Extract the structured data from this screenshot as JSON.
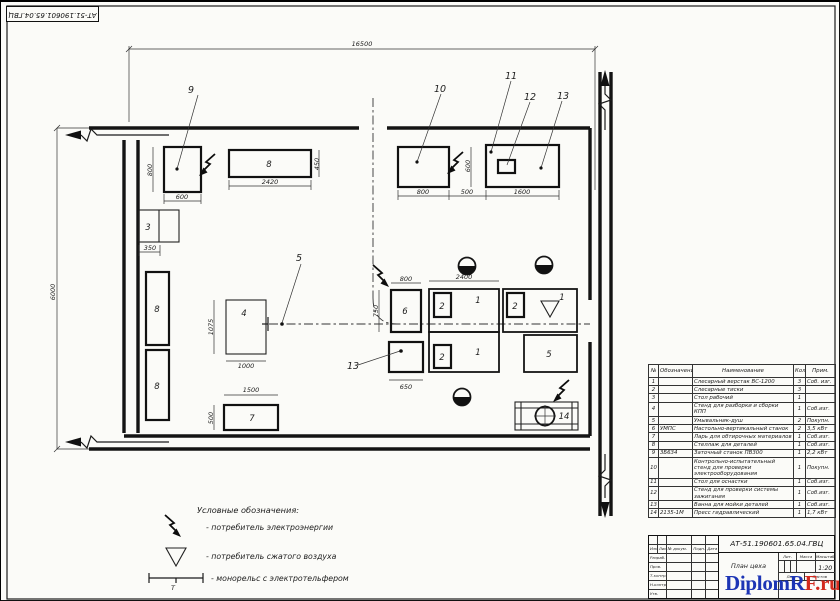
{
  "sheet": {
    "corner_designation": "АТ-51.190601.65.04.ГВЦ"
  },
  "plan": {
    "dims": {
      "overall_w": "16500",
      "overall_h": "6000",
      "i9_w": "600",
      "i9_h": "800",
      "b8_w": "2420",
      "b8_h": "450",
      "i3_w": "350",
      "i4_h": "1075",
      "i4_w": "1000",
      "i7_w": "1500",
      "i7_h": "500",
      "i6_w": "800",
      "i6_h": "750",
      "i13_w": "650",
      "wb_w": "2400",
      "i10_w": "800",
      "gap_w": "500",
      "i11_w": "1600",
      "i11_h": "600"
    },
    "labels": {
      "b8": "8",
      "r8a": "8",
      "r8b": "8",
      "i3": "3",
      "i4": "4",
      "i7": "7",
      "i6": "6",
      "wb1a": "1",
      "wb1b": "1",
      "wb1c": "1",
      "v2a": "2",
      "v2b": "2",
      "v2c": "2",
      "i5": "5",
      "i14": "14",
      "stop": "Т"
    },
    "callouts": {
      "c9": "9",
      "c10": "10",
      "c11": "11",
      "c12": "12",
      "c13": "13",
      "c5": "5",
      "c13b": "13"
    }
  },
  "legend": {
    "title": "Условные обозначения:",
    "electric": "- потребитель электроэнергии",
    "air": "- потребитель сжатого воздуха",
    "monorail": "- монорельс с электротельфером",
    "monorail_t": "Т"
  },
  "equipment_table": {
    "headers": [
      "№",
      "Обозначение",
      "Наименование",
      "Кол",
      "Прим."
    ],
    "rows": [
      {
        "n": "1",
        "code": "",
        "name": "Слесарный верстак ВС-1200",
        "qty": "3",
        "note": "Соб. изг."
      },
      {
        "n": "2",
        "code": "",
        "name": "Слесарные тиски",
        "qty": "3",
        "note": ""
      },
      {
        "n": "3",
        "code": "",
        "name": "Стол рабочий",
        "qty": "1",
        "note": ""
      },
      {
        "n": "4",
        "code": "",
        "name": "Стенд для разборки и сборки КПП",
        "qty": "1",
        "note": "Соб.изг."
      },
      {
        "n": "5",
        "code": "",
        "name": "Умывальник-душ",
        "qty": "2",
        "note": "Покупн."
      },
      {
        "n": "6",
        "code": "УМПС",
        "name": "Настольно-вертикальный станок",
        "qty": "2",
        "note": "3,5 кВт"
      },
      {
        "n": "7",
        "code": "",
        "name": "Ларь для обтирочных материалов",
        "qty": "1",
        "note": "Соб.изг."
      },
      {
        "n": "8",
        "code": "",
        "name": "Стеллаж для деталей",
        "qty": "1",
        "note": "Соб.изг."
      },
      {
        "n": "9",
        "code": "3Б634",
        "name": "Заточный станок ПВ300",
        "qty": "1",
        "note": "2,2 кВт"
      },
      {
        "n": "10",
        "code": "",
        "name": "Контрольно-испытательный стенд для проверки электрооборудования",
        "qty": "1",
        "note": "Покупн."
      },
      {
        "n": "11",
        "code": "",
        "name": "Стол для оснастки",
        "qty": "1",
        "note": "Соб.изг."
      },
      {
        "n": "12",
        "code": "",
        "name": "Стенд для проверки системы зажигания",
        "qty": "1",
        "note": "Соб.изг."
      },
      {
        "n": "13",
        "code": "",
        "name": "Ванна для мойки деталей",
        "qty": "1",
        "note": "Соб.изг."
      },
      {
        "n": "14",
        "code": "2135-1М",
        "name": "Пресс гидравлический",
        "qty": "1",
        "note": "1,7 кВт"
      }
    ]
  },
  "title_block": {
    "designation": "АТ-51.190601.65.04.ГВЦ",
    "doc_title": "План цеха",
    "scale_value": "1:20",
    "col_lit": "Лит.",
    "col_mass": "Масса",
    "col_scale": "Масштаб",
    "sheet_label": "Лист",
    "sheets_label": "Листов",
    "row_izm": "Изм.",
    "row_list": "Лист",
    "row_doc": "№ докум.",
    "row_podp": "Подп.",
    "row_date": "Дата",
    "razrab": "Разраб.",
    "prov": "Пров.",
    "tkontr": "Т.контр.",
    "nkontr": "Н.контр.",
    "utv": "Утв."
  },
  "watermark": {
    "blue": "DiplomR",
    "red": "F.ru"
  }
}
